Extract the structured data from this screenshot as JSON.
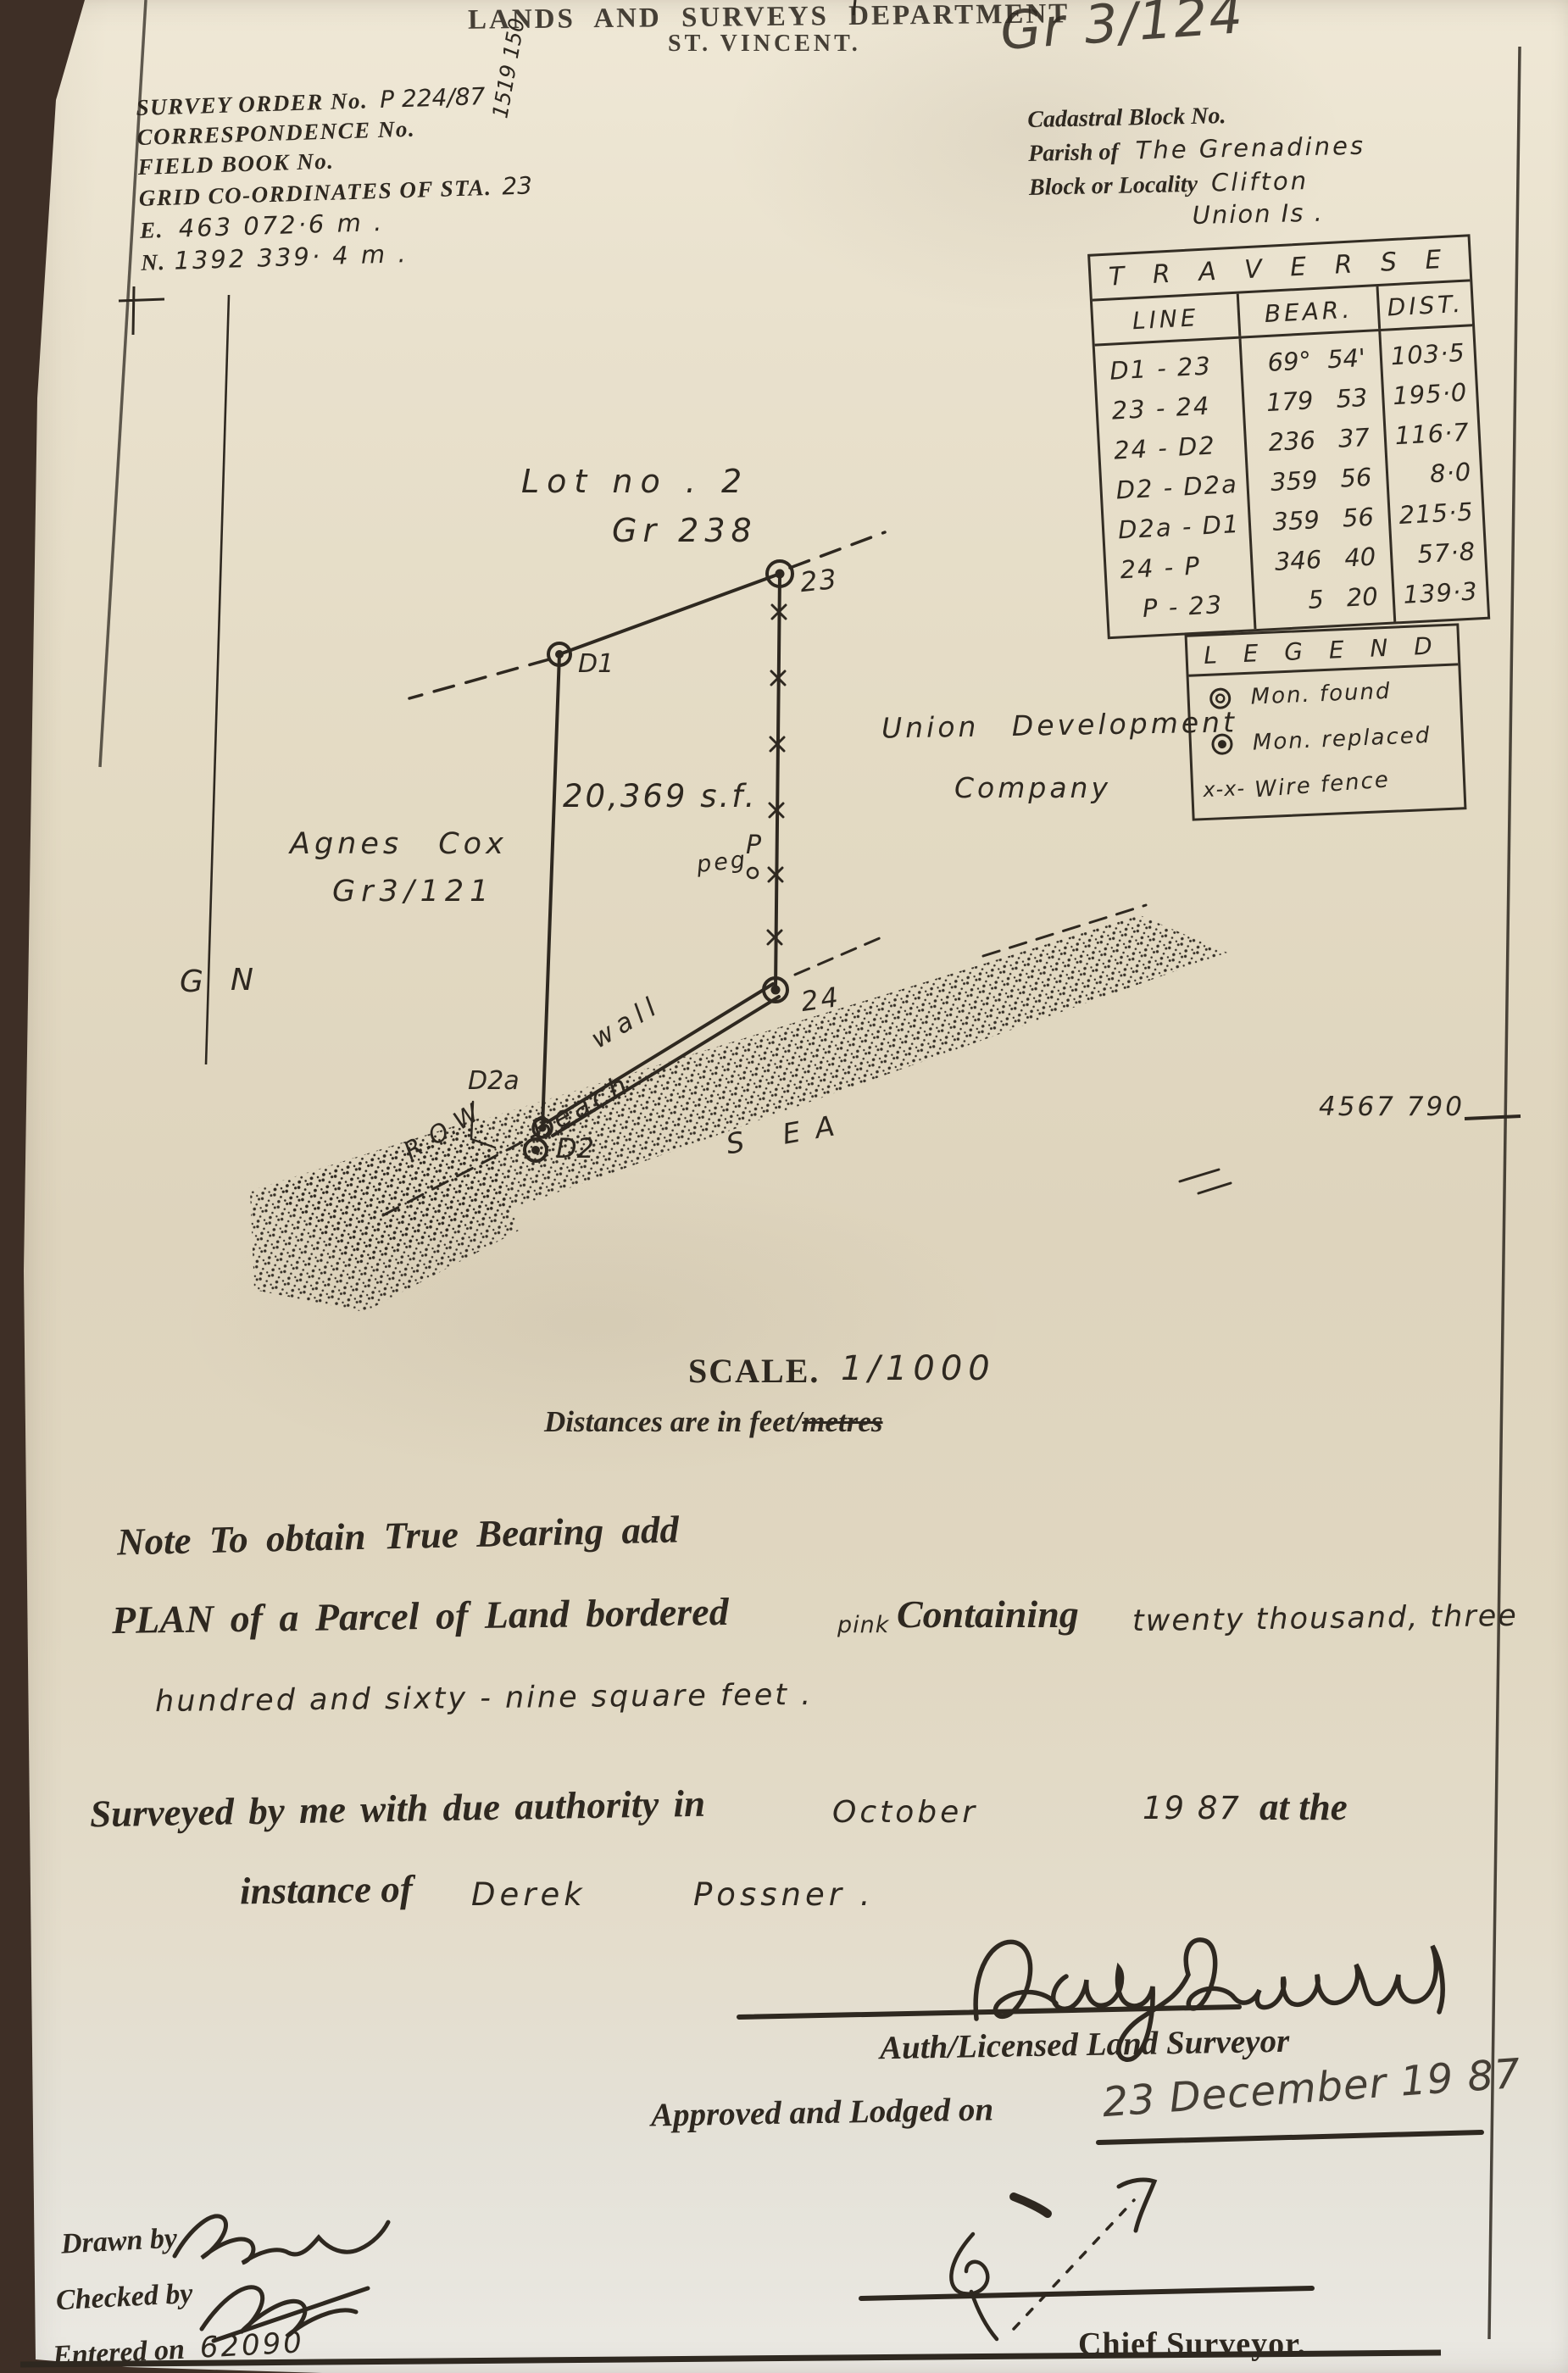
{
  "header": {
    "department": "LANDS AND SURVEYS DEPARTMENT",
    "territory": "ST. VINCENT.",
    "plan_ref": "Gr 3/124",
    "margin_note": "1519 150"
  },
  "survey_info": {
    "order_label": "SURVEY ORDER No.",
    "order_value": "P 224/87",
    "correspondence_label": "CORRESPONDENCE No.",
    "field_book_label": "FIELD BOOK No.",
    "grid_label": "GRID CO-ORDINATES OF STA.",
    "grid_station": "23",
    "easting_label": "E.",
    "easting_value": "463 072·6 m .",
    "northing_label": "N.",
    "northing_value": "1392 339· 4 m ."
  },
  "cadastral": {
    "block_label": "Cadastral Block No.",
    "parish_label": "Parish of",
    "parish_value": "The Grenadines",
    "locality_label": "Block or Locality",
    "locality_value": "Clifton",
    "island_value": "Union Is ."
  },
  "traverse_table": {
    "title": "T R A V E R S E",
    "columns": [
      "LINE",
      "BEAR.",
      "DIST."
    ],
    "rows": [
      {
        "line": "D1 -  23",
        "bear_deg": "69°",
        "bear_min": "54'",
        "dist": "103·5"
      },
      {
        "line": "23 -  24",
        "bear_deg": "179",
        "bear_min": "53",
        "dist": "195·0"
      },
      {
        "line": "24 -  D2",
        "bear_deg": "236",
        "bear_min": "37",
        "dist": "116·7"
      },
      {
        "line": "D2 - D2a",
        "bear_deg": "359",
        "bear_min": "56",
        "dist": "8·0"
      },
      {
        "line": "D2a - D1",
        "bear_deg": "359",
        "bear_min": "56",
        "dist": "215·5"
      },
      {
        "line": "24 -  P",
        "bear_deg": "346",
        "bear_min": "40",
        "dist": "57·8"
      },
      {
        "line": "P -  23",
        "bear_deg": "5",
        "bear_min": "20",
        "dist": "139·3"
      }
    ]
  },
  "legend": {
    "title": "L E G E N D",
    "items": [
      {
        "symbol": "mon-found-icon",
        "label": "Mon. found"
      },
      {
        "symbol": "mon-replaced-icon",
        "label": "Mon. replaced"
      },
      {
        "symbol": "wire-fence-icon",
        "prefix": "x-x-",
        "label": "Wire fence"
      }
    ]
  },
  "plan": {
    "lot_label": "Lot no . 2",
    "lot_ref": "Gr 238",
    "area_label": "20,369 s.f.",
    "neighbor_name": "Agnes  Cox",
    "neighbor_ref": "Gr3/121",
    "owner_line1": "Union  Development",
    "owner_line2": "Company",
    "north_g": "G",
    "north_n": "N",
    "peg_text": "peg",
    "peg_point": "P",
    "wall_label": "wall",
    "beach_label": "Beach",
    "sea_label": "S EA",
    "row_label": "R.O.W",
    "st23": "23",
    "st24": "24",
    "st_d1": "D1",
    "st_d2": "D2",
    "st_d2a": "D2a",
    "sheet_number": "4567 790"
  },
  "scale_block": {
    "label": "SCALE.",
    "value": "1/1000",
    "distances_prefix": "Distances are in feet/",
    "distances_struck": "metres"
  },
  "notes": {
    "note_line": "Note To obtain True Bearing add",
    "plan_serif": "PLAN of a Parcel of Land bordered",
    "plan_pink": "pink",
    "plan_containing": "Containing",
    "amount1": "twenty  thousand,  three",
    "amount2": "hundred   and   sixty - nine   square   feet .",
    "surveyed_prefix": "Surveyed by me with due authority in",
    "surveyed_month": "October",
    "surveyed_year": "19 87",
    "surveyed_suffix": "at the",
    "instance_prefix": "instance of",
    "instance_first": "Derek",
    "instance_last": "Possner .",
    "surveyor_title": "Auth/Licensed Land Surveyor",
    "approved_label": "Approved and Lodged on",
    "approved_date": "23 December 19 87",
    "drawn_label": "Drawn by",
    "checked_label": "Checked by",
    "entered_label": "Entered on",
    "entered_value": "62090",
    "chief_label": "Chief Surveyor."
  },
  "colors": {
    "paper": "#e3dac3",
    "ink": "#2e2820",
    "backdrop": "#3e2f26"
  }
}
